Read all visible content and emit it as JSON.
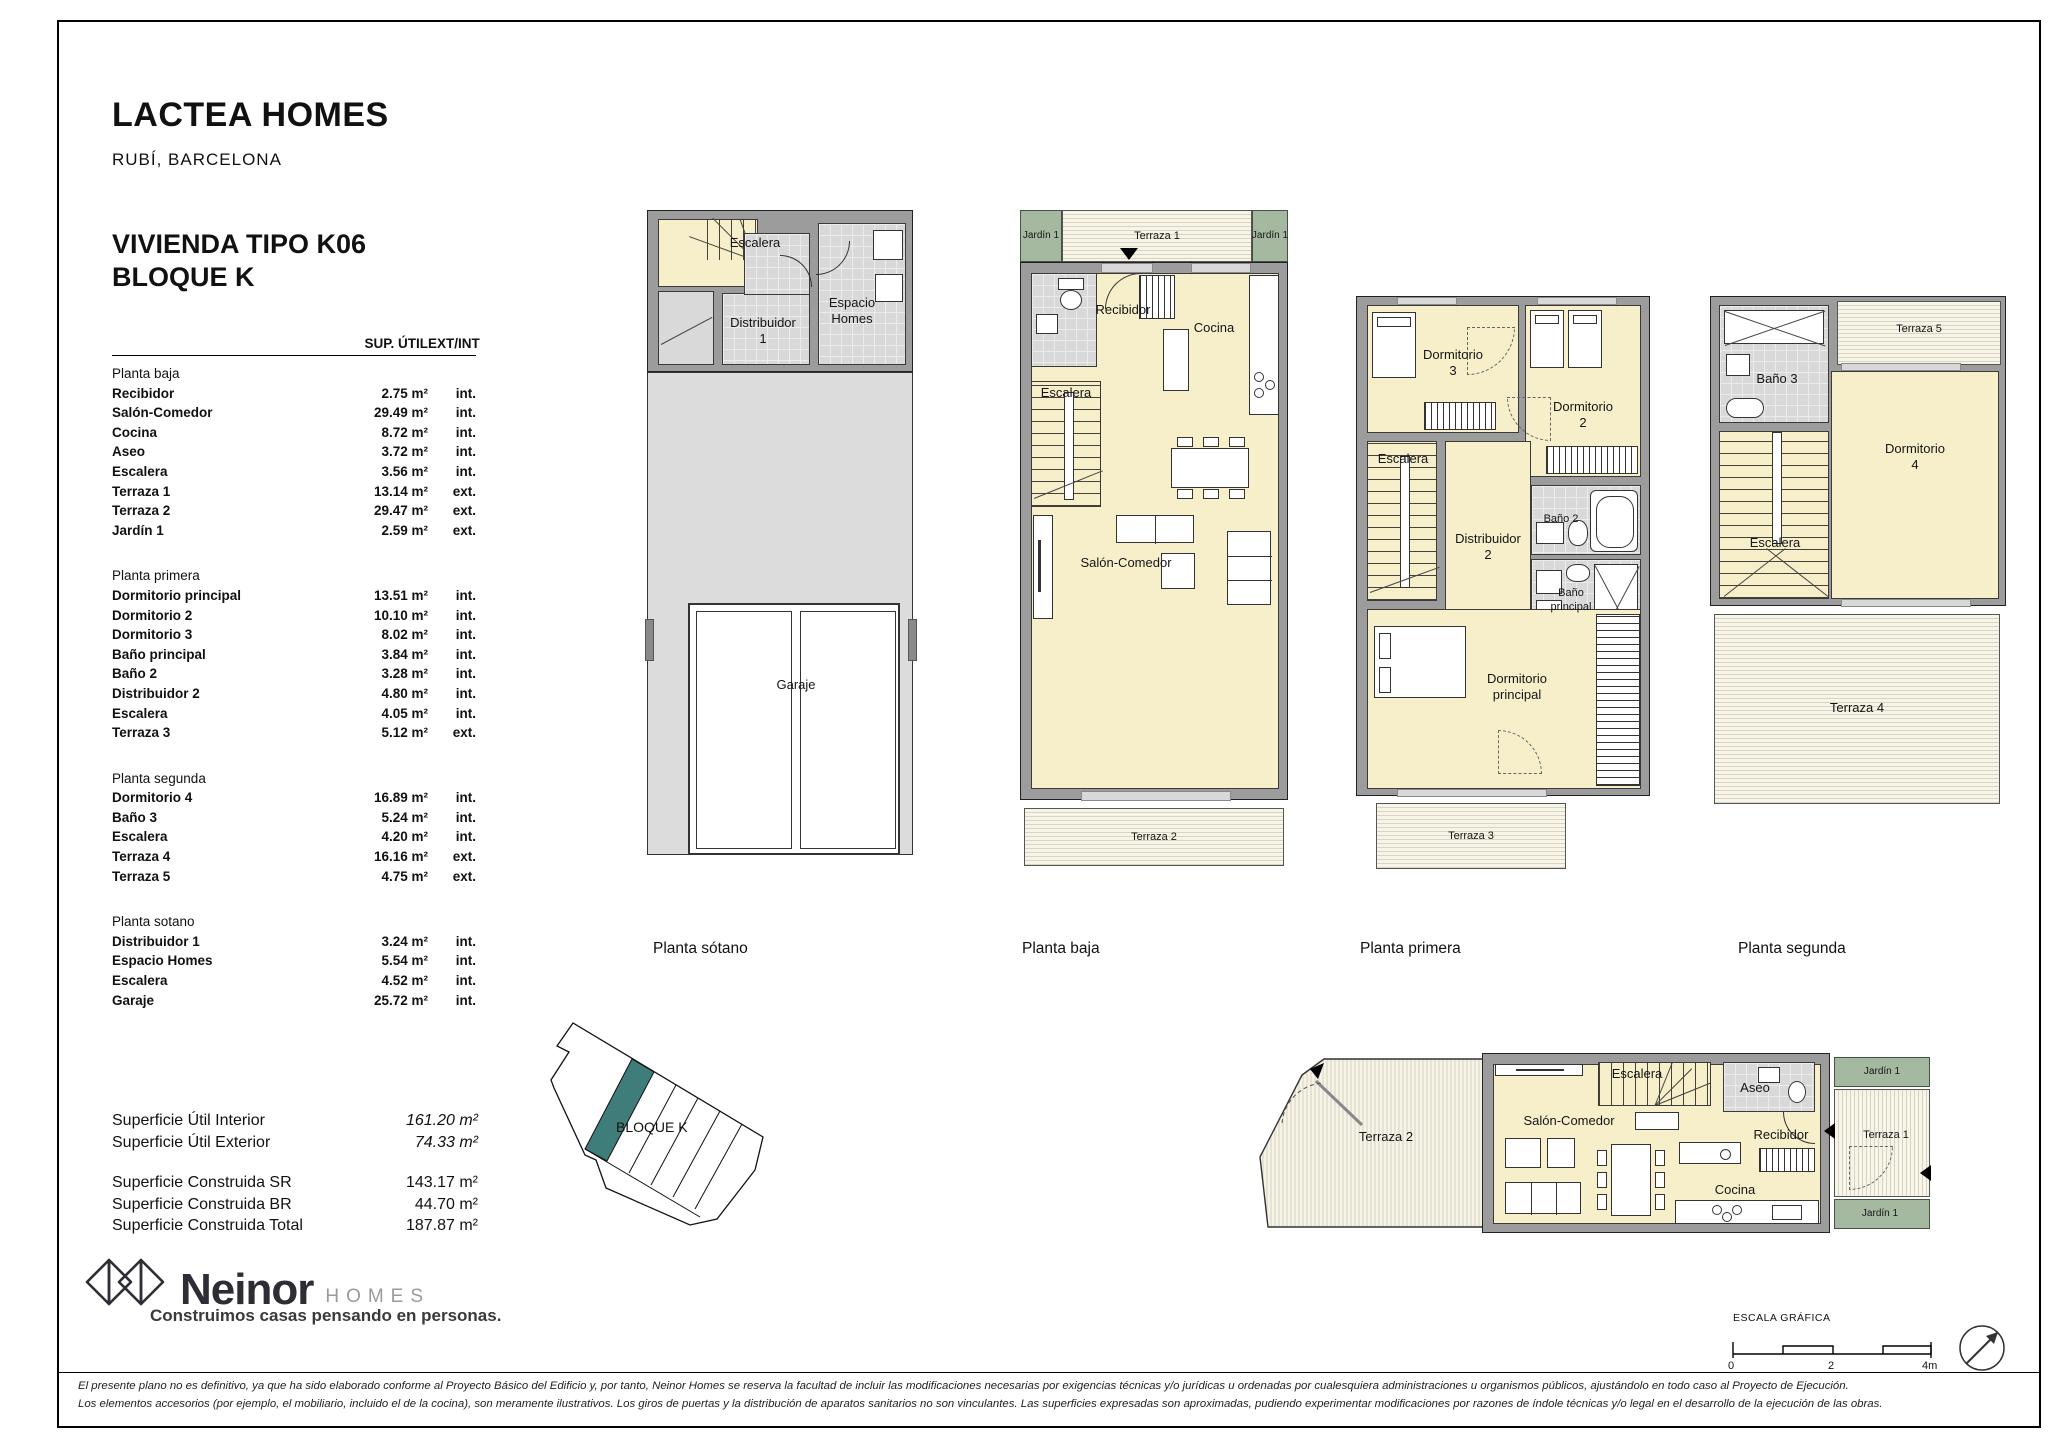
{
  "header": {
    "project": "LACTEA HOMES",
    "location": "RUBÍ, BARCELONA",
    "unit_type_line1": "VIVIENDA TIPO K06",
    "unit_type_line2": "BLOQUE K"
  },
  "table": {
    "columns": {
      "sup": "SUP. ÚTIL",
      "ext": "EXT/INT"
    },
    "sections": [
      {
        "name": "Planta baja",
        "rows": [
          {
            "label": "Recibidor",
            "value": "2.75 m²",
            "type": "int."
          },
          {
            "label": "Salón-Comedor",
            "value": "29.49 m²",
            "type": "int."
          },
          {
            "label": "Cocina",
            "value": "8.72 m²",
            "type": "int."
          },
          {
            "label": "Aseo",
            "value": "3.72 m²",
            "type": "int."
          },
          {
            "label": "Escalera",
            "value": "3.56 m²",
            "type": "int."
          },
          {
            "label": "Terraza 1",
            "value": "13.14 m²",
            "type": "ext."
          },
          {
            "label": "Terraza 2",
            "value": "29.47 m²",
            "type": "ext."
          },
          {
            "label": "Jardín 1",
            "value": "2.59 m²",
            "type": "ext."
          }
        ]
      },
      {
        "name": "Planta primera",
        "rows": [
          {
            "label": "Dormitorio principal",
            "value": "13.51 m²",
            "type": "int."
          },
          {
            "label": "Dormitorio 2",
            "value": "10.10 m²",
            "type": "int."
          },
          {
            "label": "Dormitorio 3",
            "value": "8.02 m²",
            "type": "int."
          },
          {
            "label": "Baño principal",
            "value": "3.84 m²",
            "type": "int."
          },
          {
            "label": "Baño 2",
            "value": "3.28 m²",
            "type": "int."
          },
          {
            "label": "Distribuidor 2",
            "value": "4.80 m²",
            "type": "int."
          },
          {
            "label": "Escalera",
            "value": "4.05 m²",
            "type": "int."
          },
          {
            "label": "Terraza 3",
            "value": "5.12 m²",
            "type": "ext."
          }
        ]
      },
      {
        "name": "Planta segunda",
        "rows": [
          {
            "label": "Dormitorio 4",
            "value": "16.89 m²",
            "type": "int."
          },
          {
            "label": "Baño 3",
            "value": "5.24 m²",
            "type": "int."
          },
          {
            "label": "Escalera",
            "value": "4.20 m²",
            "type": "int."
          },
          {
            "label": "Terraza 4",
            "value": "16.16 m²",
            "type": "ext."
          },
          {
            "label": "Terraza 5",
            "value": "4.75 m²",
            "type": "ext."
          }
        ]
      },
      {
        "name": "Planta sotano",
        "rows": [
          {
            "label": "Distribuidor 1",
            "value": "3.24 m²",
            "type": "int."
          },
          {
            "label": "Espacio Homes",
            "value": "5.54 m²",
            "type": "int."
          },
          {
            "label": "Escalera",
            "value": "4.52 m²",
            "type": "int."
          },
          {
            "label": "Garaje",
            "value": "25.72 m²",
            "type": "int."
          }
        ]
      }
    ]
  },
  "summary": {
    "util": [
      {
        "label": "Superficie Útil Interior",
        "value": "161.20 m²"
      },
      {
        "label": "Superficie Útil Exterior",
        "value": "74.33 m²"
      }
    ],
    "construida": [
      {
        "label": "Superficie Construida SR",
        "value": "143.17 m²"
      },
      {
        "label": "Superficie Construida BR",
        "value": "44.70 m²"
      },
      {
        "label": "Superficie Construida Total",
        "value": "187.87 m²"
      }
    ]
  },
  "logo": {
    "brand": "Neinor",
    "suffix": "HOMES",
    "tagline": "Construimos casas pensando en personas."
  },
  "site_key": {
    "block_label": "BLOQUE K",
    "highlight_color": "#3f7d7a"
  },
  "plans": {
    "sotano": {
      "caption": "Planta sótano",
      "rooms": {
        "escalera": "Escalera",
        "distribuidor": "Distribuidor",
        "distribuidor_num": "1",
        "espacio_l1": "Espacio",
        "espacio_l2": "Homes",
        "garaje": "Garaje"
      }
    },
    "baja": {
      "caption": "Planta baja",
      "rooms": {
        "jardin": "Jardín 1",
        "terraza1": "Terraza 1",
        "aseo": "Aseo",
        "recibidor": "Recibidor",
        "cocina": "Cocina",
        "escalera": "Escalera",
        "salon": "Salón-Comedor",
        "terraza2": "Terraza 2"
      }
    },
    "primera": {
      "caption": "Planta primera",
      "rooms": {
        "dorm3_l1": "Dormitorio",
        "dorm3_l2": "3",
        "dorm2_l1": "Dormitorio",
        "dorm2_l2": "2",
        "escalera": "Escalera",
        "distribuidor_l1": "Distribuidor",
        "distribuidor_l2": "2",
        "bano2": "Baño 2",
        "banop_l1": "Baño",
        "banop_l2": "principal",
        "dormp_l1": "Dormitorio",
        "dormp_l2": "principal",
        "terraza3": "Terraza 3"
      }
    },
    "segunda": {
      "caption": "Planta segunda",
      "rooms": {
        "terraza5": "Terraza 5",
        "bano3": "Baño 3",
        "dorm4_l1": "Dormitorio",
        "dorm4_l2": "4",
        "escalera": "Escalera",
        "terraza4": "Terraza 4"
      }
    },
    "horizontal": {
      "rooms": {
        "terraza2": "Terraza 2",
        "salon": "Salón-Comedor",
        "escalera": "Escalera",
        "aseo": "Aseo",
        "recibidor": "Recibidor",
        "cocina": "Cocina",
        "jardin": "Jardín 1",
        "terraza1": "Terraza 1"
      }
    }
  },
  "scale_bar": {
    "title": "ESCALA GRÁFICA",
    "tick0": "0",
    "tick2": "2",
    "tick4": "4m"
  },
  "disclaimer": {
    "line1": "El presente plano no es definitivo, ya que ha sido elaborado conforme al Proyecto Básico del Edificio y, por tanto, Neinor Homes se reserva la facultad de incluir las modificaciones necesarias por exigencias técnicas y/o jurídicas u ordenadas por cualesquiera administraciones u organismos públicos, ajustándolo en todo caso al Proyecto de Ejecución.",
    "line2": "Los elementos accesorios (por ejemplo, el mobiliario, incluido el de la cocina), son meramente ilustrativos. Los giros de puertas y la distribución de aparatos sanitarios no son vinculantes. Las superficies expresadas son aproximadas, pudiendo experimentar modificaciones por razones de índole técnicas y/o legal en el desarrollo de la ejecución de las obras."
  }
}
